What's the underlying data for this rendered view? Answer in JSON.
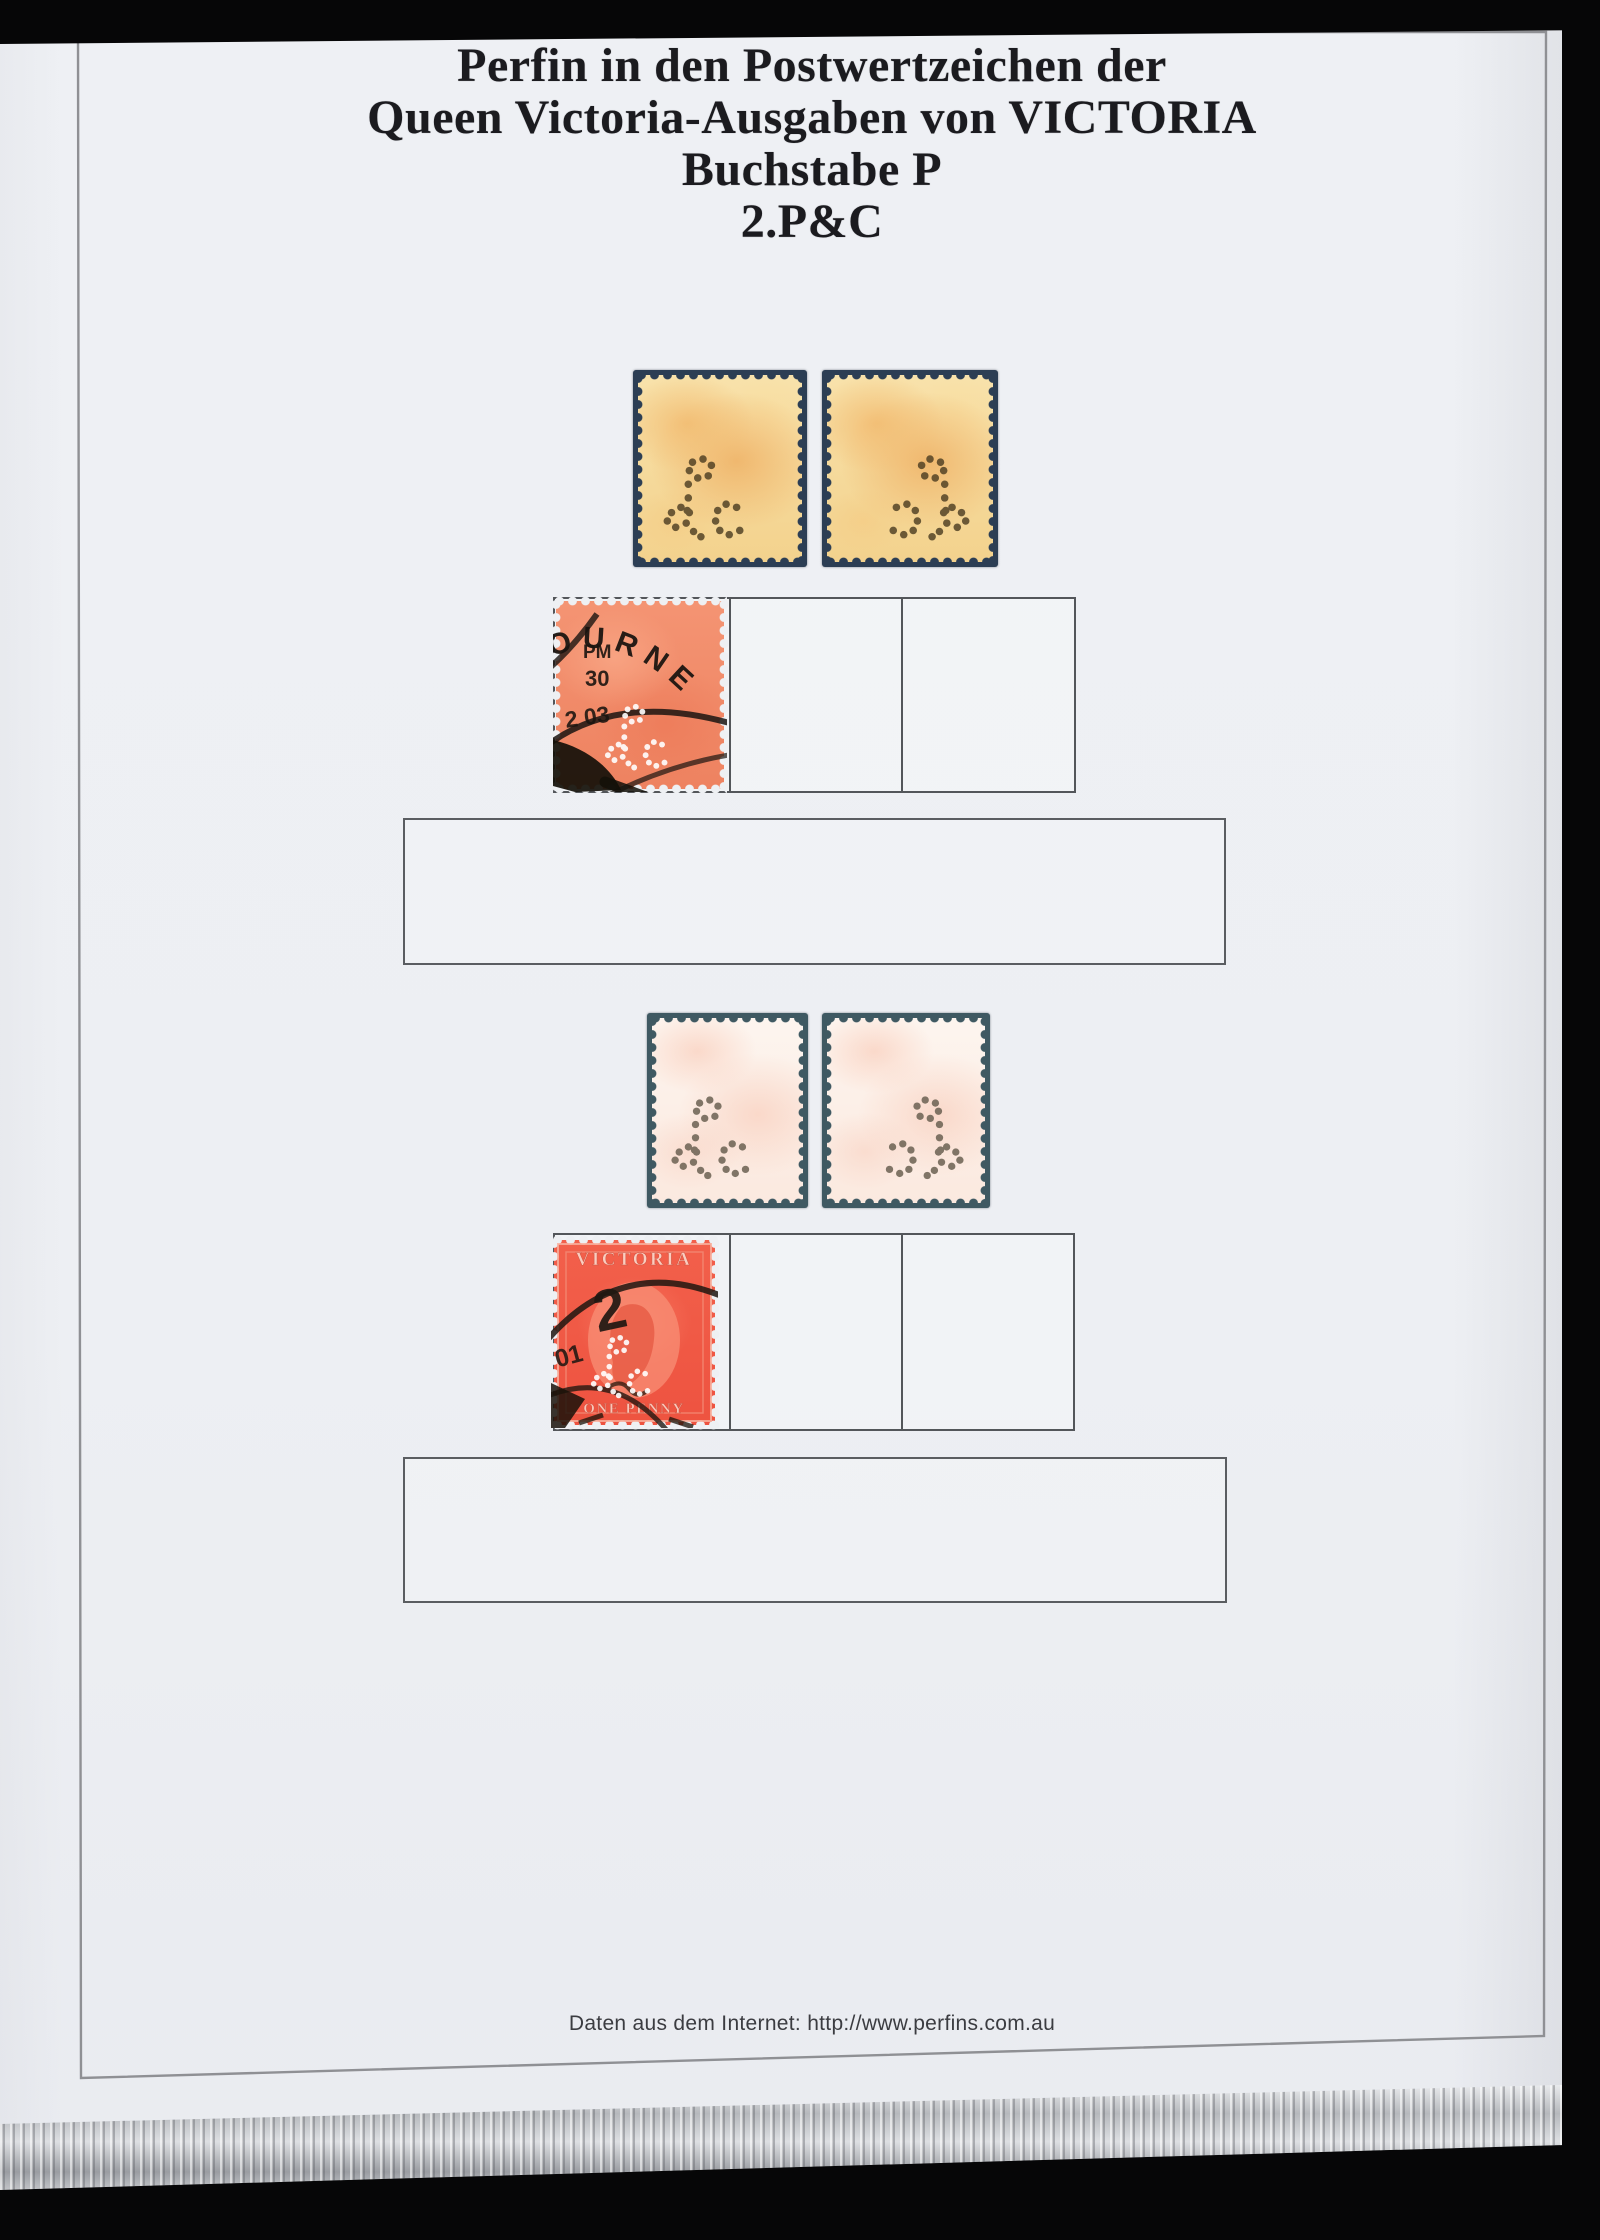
{
  "page": {
    "title_lines": [
      "Perfin in den Postwertzeichen der",
      "Queen Victoria-Ausgaben von VICTORIA",
      "Buchstabe P",
      "2.P&C"
    ],
    "footer": "Daten aus dem Internet: http://www.perfins.com.au"
  },
  "stamps": {
    "perfin_letters": "P&C",
    "melbourne_cancel": {
      "arc_text": "OURNE",
      "pm": "PM",
      "day": "30",
      "date": "2 03"
    },
    "victoria_red": {
      "country": "VICTORIA",
      "denomination": "ONE PENNY",
      "cancel_numeral": "2",
      "cancel_digits": "01"
    }
  },
  "colors": {
    "page_background": "#eef0f3",
    "orange_stamp": "#f5d795",
    "pink_stamp": "#fbeee6",
    "salmon_stamp": "#f08a64",
    "red_stamp": "#f15a45",
    "perforation_navy": "#2c3e54",
    "perforation_teal": "#3f5962",
    "surround_black": "#060607"
  }
}
